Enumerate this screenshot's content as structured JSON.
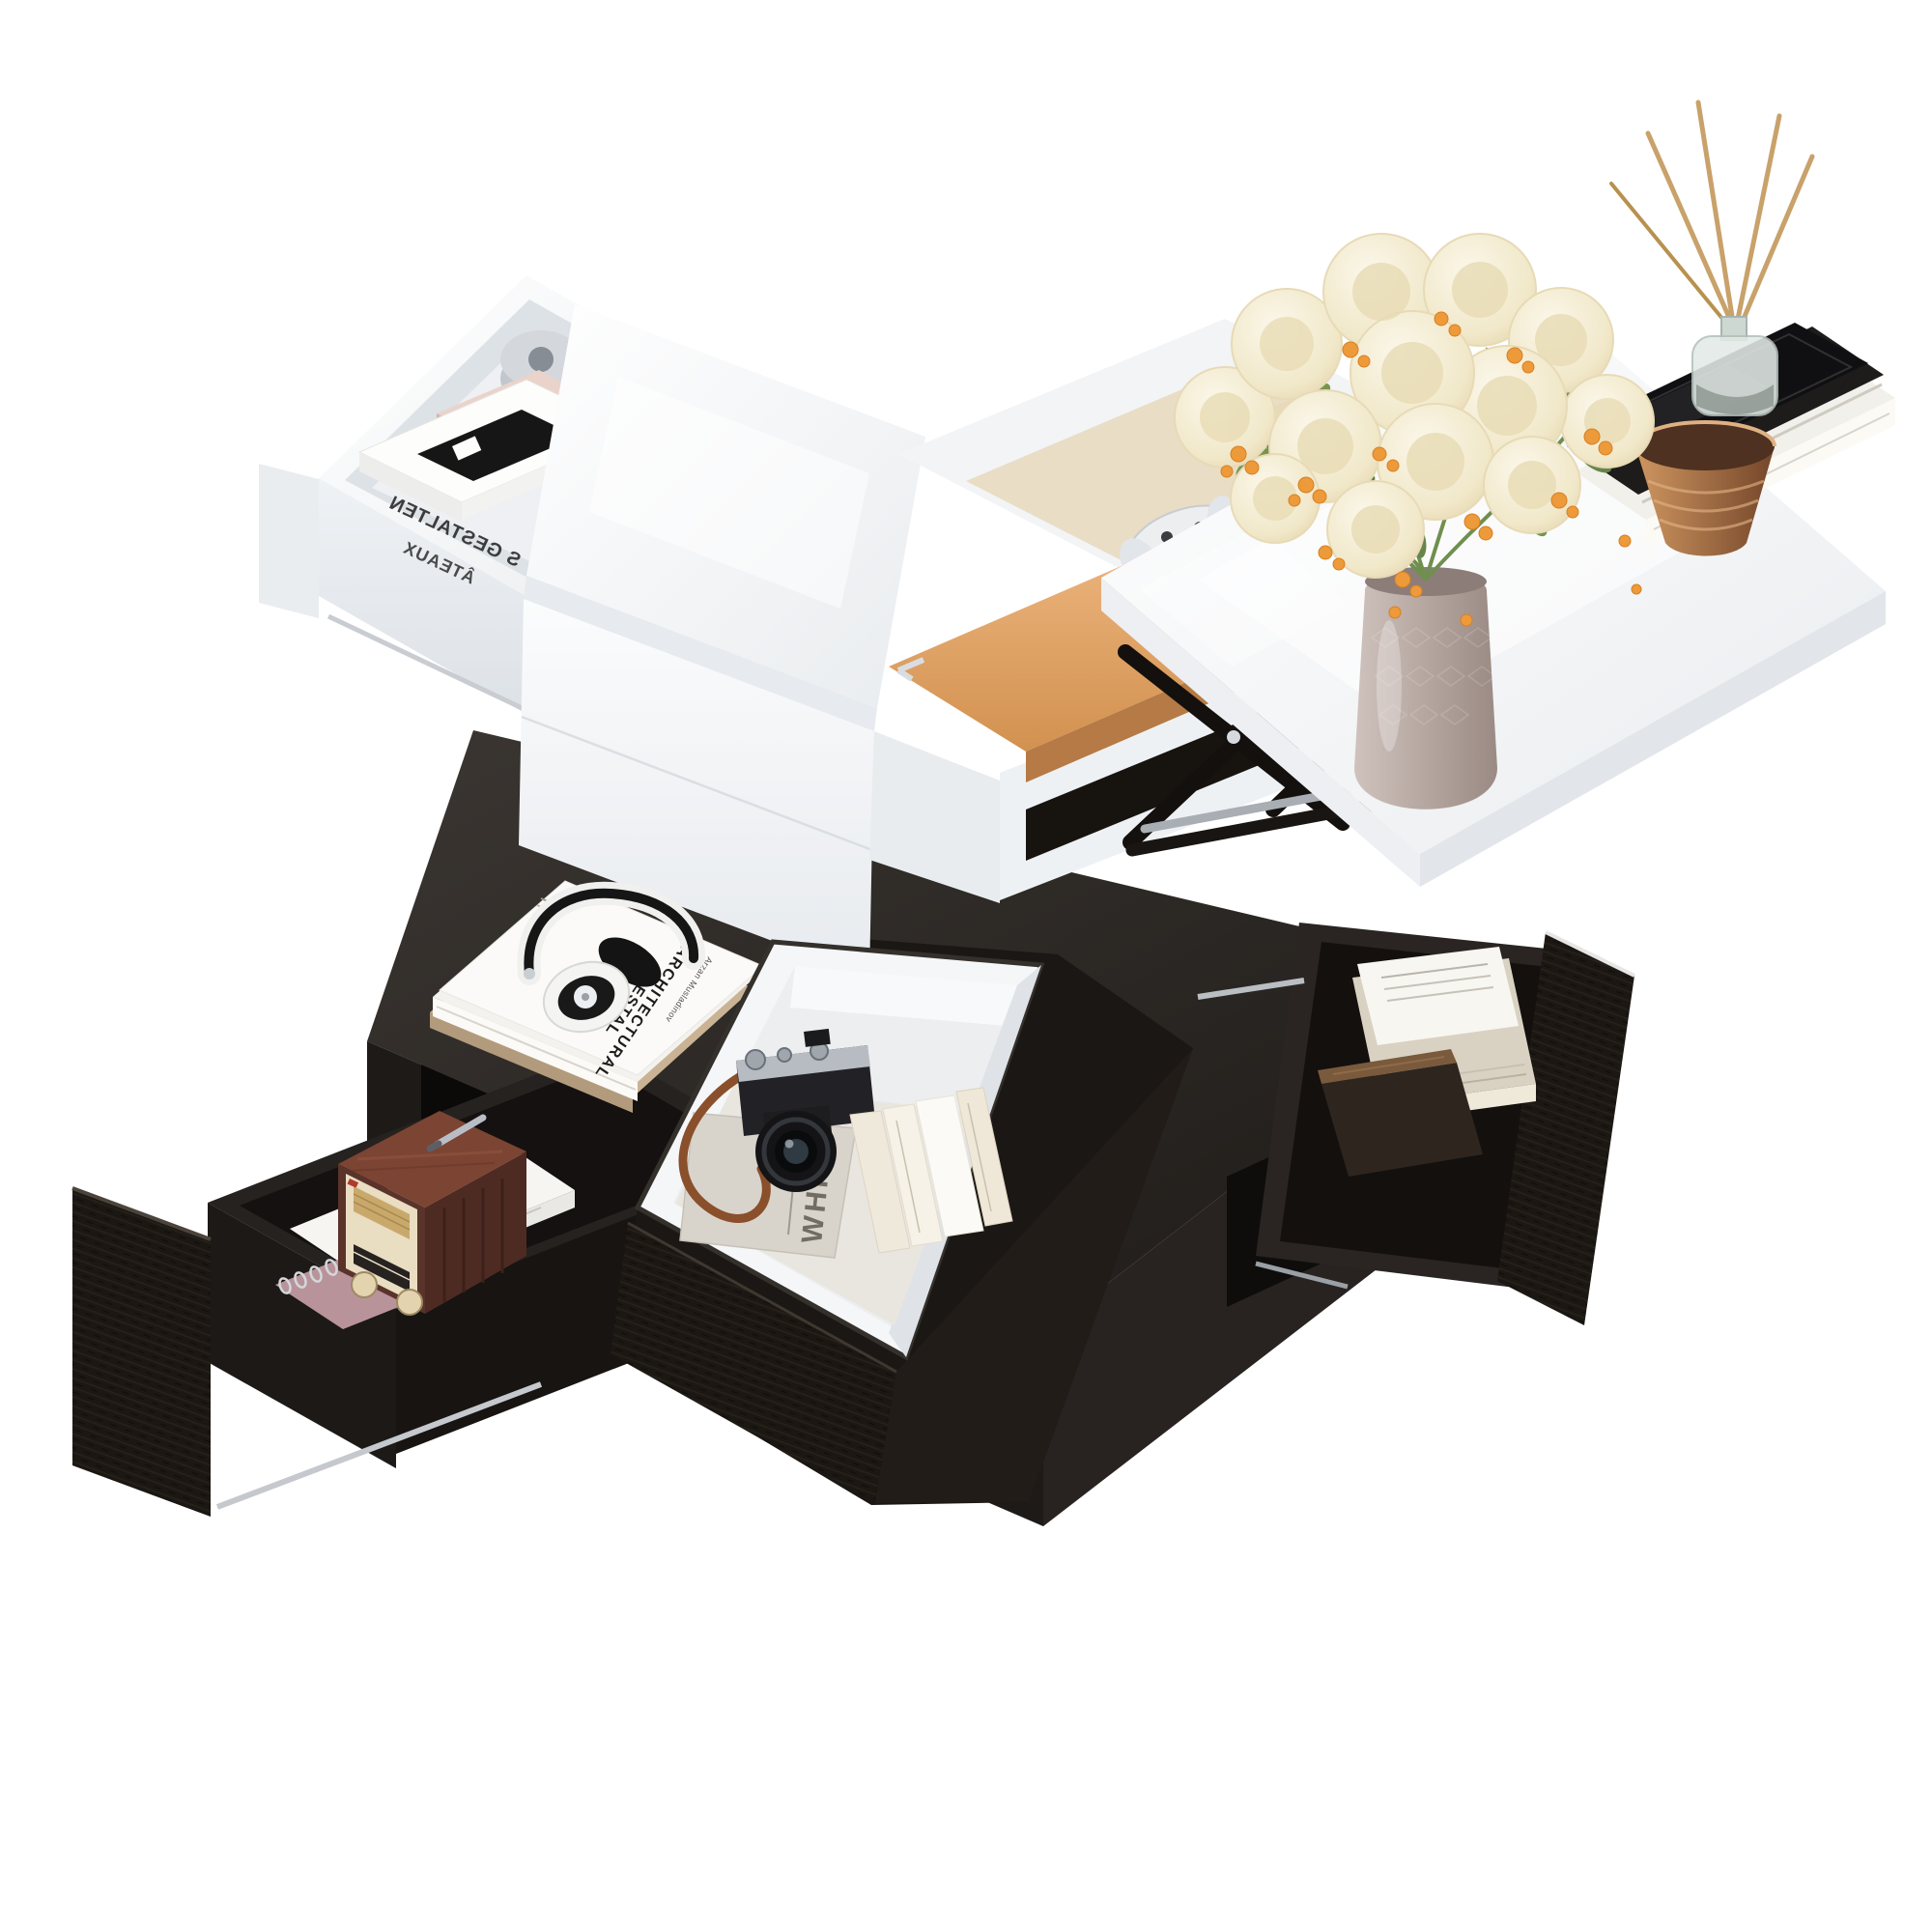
{
  "page": {
    "background": "#ffffff",
    "subject": "Product photo: multifunctional lift-top coffee table, white high-gloss top with black storage base, drawers open and styled with decor"
  },
  "palette": {
    "table_gloss_white": "#f4f6f8",
    "base_black": "#25211e",
    "drawer_front_texture": "#1b1712",
    "leather_tan": "#e3a76f",
    "fabric_cream": "#eadfc9",
    "copper_brown": "#b8855a",
    "flower_cream": "#f4eed7",
    "berry_orange": "#ec9a3a",
    "leaf_green": "#76944e",
    "vase_taupe": "#b3a29c",
    "radio_wood": "#7c4433",
    "camera_strap_brown": "#8a4f2b"
  },
  "props": {
    "coffee_table_book": {
      "title_line1": "ARCHITECTURAL",
      "title_line2": "GESTAL",
      "author": "Arzan Musladinov"
    },
    "storage_magazine": {
      "title": "WHITE"
    },
    "upper_drawer_book": {
      "line1": "S GESTALTEN",
      "line2": "ÂTEAUX",
      "mirrored": true
    }
  },
  "objects": [
    {
      "name": "lift-top-panel",
      "label": "white gloss lift-up tabletop"
    },
    {
      "name": "lift-mechanism",
      "label": "black metal scissor lift arms"
    },
    {
      "name": "flower-bouquet",
      "label": "cream pom-pom flowers with orange berries and green leaves"
    },
    {
      "name": "flower-vase",
      "label": "taupe textured ceramic vase"
    },
    {
      "name": "decor-tray",
      "label": "black glossy tray"
    },
    {
      "name": "reed-diffuser",
      "label": "glass reed diffuser with rattan sticks"
    },
    {
      "name": "copper-cup",
      "label": "ribbed copper cup"
    },
    {
      "name": "tray-book-stack",
      "label": "black and white books under tray"
    },
    {
      "name": "top-drawer",
      "label": "white pull-out tabletop drawer"
    },
    {
      "name": "tape-dispenser",
      "label": "silver tape dispenser"
    },
    {
      "name": "gift-box",
      "label": "blush pink box with silver clip"
    },
    {
      "name": "face-down-book",
      "label": "face-down book with mirrored cover text"
    },
    {
      "name": "hidden-compartment",
      "label": "under-top storage compartment with cream fabric and tan leather"
    },
    {
      "name": "game-controller",
      "label": "white game controller"
    },
    {
      "name": "leather-lid",
      "label": "tan leather compartment lid with chrome corners"
    },
    {
      "name": "storage-shelf-slot",
      "label": "open white side shelf with dark slot"
    },
    {
      "name": "coffee-table-books",
      "label": "stack of art books on base top"
    },
    {
      "name": "headphones",
      "label": "white and black on-ear headphones"
    },
    {
      "name": "center-storage-insert",
      "label": "white open storage cube in center drawer"
    },
    {
      "name": "camera",
      "label": "retro mirrorless camera with leather strap"
    },
    {
      "name": "standing-books",
      "label": "four cream hardcover books"
    },
    {
      "name": "right-drawer",
      "label": "black textured drawer with magazines and wooden case"
    },
    {
      "name": "left-drawer",
      "label": "black textured drawer with radio"
    },
    {
      "name": "vintage-radio",
      "label": "retro wooden radio with cream dial panel"
    },
    {
      "name": "spiral-notebook",
      "label": "mauve spiral-bound notebook"
    },
    {
      "name": "silver-pen",
      "label": "silver pen"
    }
  ]
}
